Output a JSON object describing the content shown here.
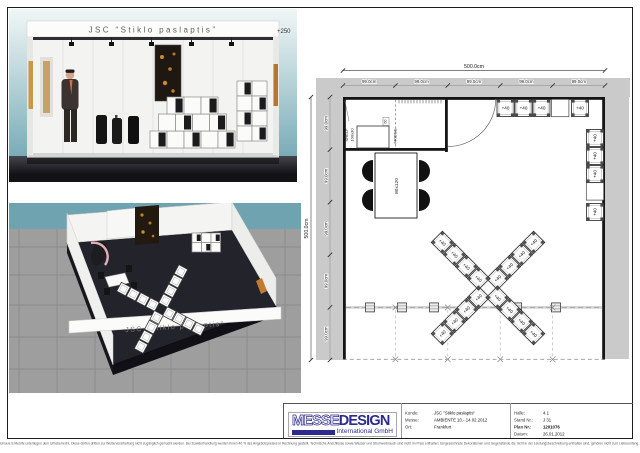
{
  "renders": {
    "booth_title": "JSC “Stiklo paslaptis”",
    "fascia_height_label": "+250"
  },
  "plan": {
    "total_width_label": "500.0cm",
    "total_height_label": "500.0cm",
    "top_segment_labels": [
      "99.0cm",
      "99.0cm",
      "99.0cm",
      "99.0cm",
      "99.0cm"
    ],
    "left_segment_labels": [
      "99.0cm",
      "99.0cm",
      "99.0cm",
      "99.0cm",
      "99.0cm"
    ],
    "shelf_label_line1": "SHELF",
    "shelf_label_line2": "100x30",
    "fridge_label": "FRIDGE",
    "fridge_width_label": "60",
    "table_label": "80x120",
    "cube_label": "+40",
    "cubes": {
      "top_row": 4,
      "right_column": 4,
      "x_display": 16
    }
  },
  "titleblock": {
    "logo": {
      "part1": "MESSE",
      "part2": "DESIGN",
      "subtitle": "International GmbH"
    },
    "fields": [
      {
        "label": "Kunde:",
        "value": "JSC \"Stiklo paslaptis\""
      },
      {
        "label": "Messe:",
        "value": "AMBIENTE 10.- 14.02.2012"
      },
      {
        "label": "Ort:",
        "value": "Frankfurt"
      },
      {
        "label": "Halle:",
        "value": "4.1"
      },
      {
        "label": "Stand Nr.:",
        "value": "J 31"
      },
      {
        "label": "Plan Nr.:",
        "value": "1201076"
      },
      {
        "label": "Datum:",
        "value": "26.01.2012"
      }
    ]
  },
  "sheet": {
    "footer_disclaimer": "Unsere Entwürfe unterliegen dem Urheberrecht. Diese dürfen dritten zur Weiterverarbeitung nicht zugänglich gemacht werden. Bei Zuwiderhandlung werden Ihnen 40 % des Angebotspreises in Rechnung gestellt. Technische Anschlüsse sowie Wasser und Stromverbrauch sind nicht im Preis enthalten. Eingezeichnete Dekorationen und Gegenstände die nicht in der Leistungsbeschreibung enthalten sind, gehören nicht zum Lieferumfang. Änderungen durch die Messe bleiben vorbehalten."
  },
  "colors": {
    "brand_navy": "#2b2b8e",
    "sky_teal": "#7aacb8",
    "hall_floor_gray": "#9e9e9e",
    "neighbor_band_gray": "#cacaca",
    "booth_floor_dark": "#23232b"
  }
}
